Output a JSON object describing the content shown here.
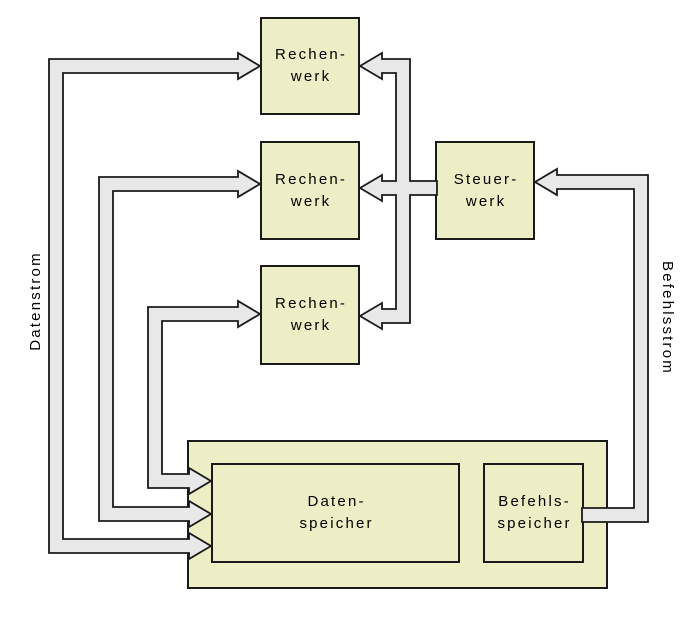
{
  "colors": {
    "background": "#ffffff",
    "box_fill": "#edeec5",
    "bus_fill": "#e8e8e8",
    "outline": "#1a1a1a"
  },
  "nodes": {
    "rechenwerk_1": {
      "lines": [
        "Rechen-",
        "werk"
      ]
    },
    "rechenwerk_2": {
      "lines": [
        "Rechen-",
        "werk"
      ]
    },
    "rechenwerk_3": {
      "lines": [
        "Rechen-",
        "werk"
      ]
    },
    "steuerwerk": {
      "lines": [
        "Steuer-",
        "werk"
      ]
    },
    "datenspeicher": {
      "lines": [
        "Daten-",
        "speicher"
      ]
    },
    "befehlsspeicher": {
      "lines": [
        "Befehls-",
        "speicher"
      ]
    }
  },
  "stream_labels": {
    "data_stream": "Datenstrom",
    "instruction_stream": "Befehlsstrom"
  },
  "edges": [
    {
      "id": "data-bus-1",
      "between": [
        "datenspeicher",
        "rechenwerk_1"
      ],
      "arrows": "both",
      "stream": "Datenstrom"
    },
    {
      "id": "data-bus-2",
      "between": [
        "datenspeicher",
        "rechenwerk_2"
      ],
      "arrows": "both",
      "stream": "Datenstrom"
    },
    {
      "id": "data-bus-3",
      "between": [
        "datenspeicher",
        "rechenwerk_3"
      ],
      "arrows": "both",
      "stream": "Datenstrom"
    },
    {
      "id": "control-bus",
      "from": "steuerwerk",
      "to": [
        "rechenwerk_1",
        "rechenwerk_2",
        "rechenwerk_3"
      ],
      "arrows": "to"
    },
    {
      "id": "instruction-bus",
      "from": "befehlsspeicher",
      "to": "steuerwerk",
      "arrows": "to",
      "stream": "Befehlsstrom"
    }
  ]
}
